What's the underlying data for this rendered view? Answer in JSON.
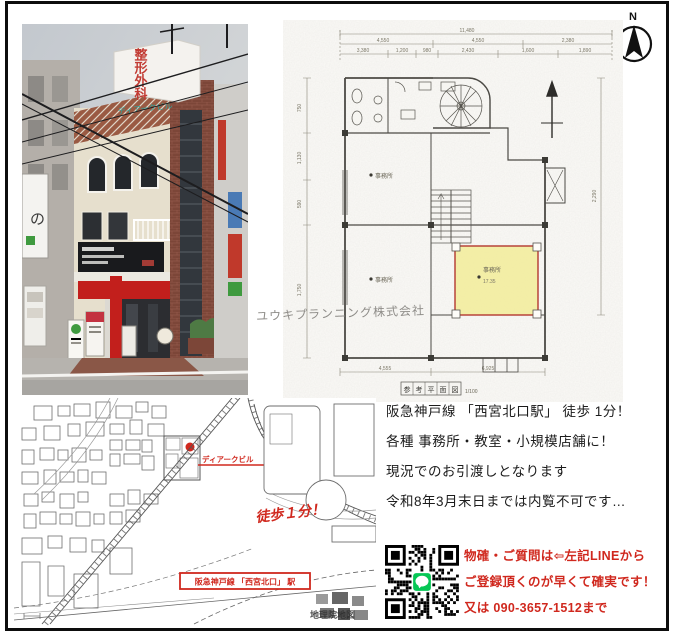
{
  "photo": {
    "rooftop_sign_text": "整形外科",
    "building_name_sign": "ディアークビル",
    "side_sign_text": "の"
  },
  "compass": {
    "label": "N"
  },
  "plan": {
    "watermark": "ユウキプランニング株式会社",
    "caption_chars": [
      "参",
      "考",
      "平",
      "面",
      "図"
    ],
    "caption_scale": "1/100",
    "room_labels": {
      "mid": "事務所",
      "lower": "事務所",
      "highlight": "事務所",
      "highlight_area": "17.35"
    },
    "dims": {
      "top1": "11,480",
      "top2_0": "4,550",
      "top2_1": "4,550",
      "top2_2": "2,380",
      "top3_0": "3,380",
      "top3_1": "1,200",
      "top3_2": "980",
      "top3_3": "2,430",
      "top3_4": "1,600",
      "top3_5": "1,890",
      "left_0": "750",
      "left_1": "1,130",
      "left_2": "590",
      "left_3": "1,750",
      "right_0": "2,290",
      "bottom_0": "4,555",
      "bottom_1": "6,925"
    }
  },
  "map": {
    "marker_label": "ディアークビル",
    "walk_note": "徒歩１分！",
    "station_label": "阪急神戸線 「西宮北口」 駅",
    "watermark": "地理院地図"
  },
  "description": {
    "lines": [
      "阪急神戸線 「西宮北口駅」 徒歩 1分！",
      "各種 事務所・教室・小規模店舗に！",
      "現況でのお引渡しとなります",
      "令和8年3月末日までは内覧不可です…"
    ]
  },
  "contact": {
    "lines": [
      "物確・ご質問は⇦左記LINEから",
      "ご登録頂くのが早くて確実です！",
      "又は 090-3657-1512まで"
    ]
  },
  "colors": {
    "accent_red": "#d0281e",
    "highlight_yellow": "#f2eda0",
    "line_green": "#06C755"
  }
}
